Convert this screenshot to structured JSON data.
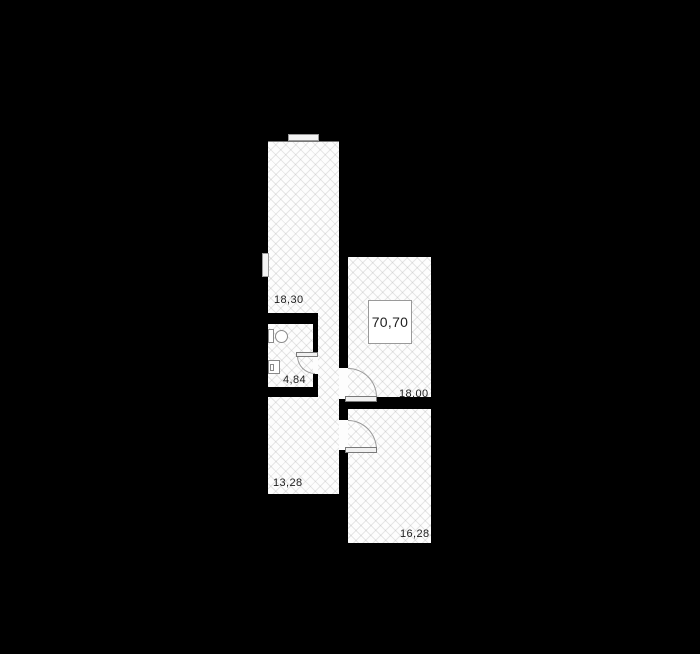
{
  "floorplan": {
    "type": "apartment-floor-plan",
    "total_area": {
      "value": "70,70"
    },
    "rooms": {
      "r18_30": {
        "area": "18,30"
      },
      "r4_84": {
        "area": "4,84"
      },
      "r18_00": {
        "area": "18,00"
      },
      "r13_28": {
        "area": "13,28"
      },
      "r16_28": {
        "area": "16,28"
      }
    },
    "colors": {
      "background": "#000000",
      "floor": "#fdfdfd",
      "wall": "#000000",
      "hatch_line": "#e9e9e9",
      "outline": "#9a9a9a",
      "text": "#1d1d1d"
    }
  }
}
